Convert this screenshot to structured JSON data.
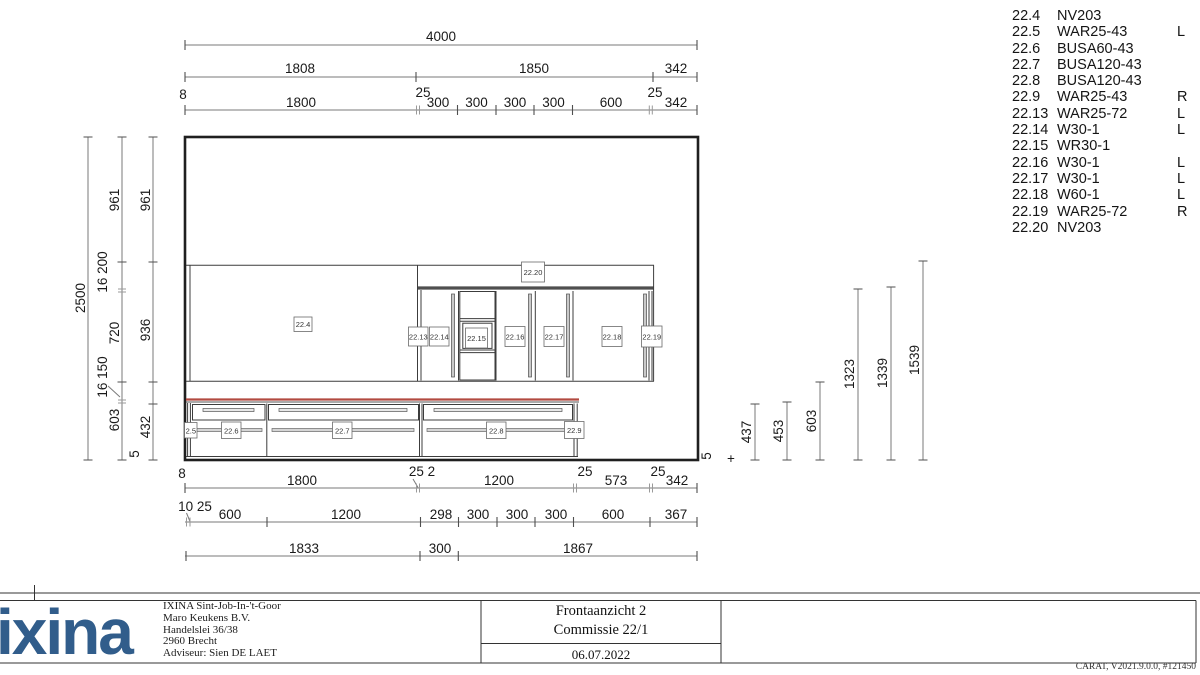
{
  "parts_list": {
    "rows": [
      {
        "code": "22.4",
        "name": "NV203",
        "side": ""
      },
      {
        "code": "22.5",
        "name": "WAR25-43",
        "side": "L"
      },
      {
        "code": "22.6",
        "name": "BUSA60-43",
        "side": ""
      },
      {
        "code": "22.7",
        "name": "BUSA120-43",
        "side": ""
      },
      {
        "code": "22.8",
        "name": "BUSA120-43",
        "side": ""
      },
      {
        "code": "22.9",
        "name": "WAR25-43",
        "side": "R"
      },
      {
        "code": "22.13",
        "name": "WAR25-72",
        "side": "L"
      },
      {
        "code": "22.14",
        "name": "W30-1",
        "side": "L"
      },
      {
        "code": "22.15",
        "name": "WR30-1",
        "side": ""
      },
      {
        "code": "22.16",
        "name": "W30-1",
        "side": "L"
      },
      {
        "code": "22.17",
        "name": "W30-1",
        "side": "L"
      },
      {
        "code": "22.18",
        "name": "W60-1",
        "side": "L"
      },
      {
        "code": "22.19",
        "name": "WAR25-72",
        "side": "R"
      },
      {
        "code": "22.20",
        "name": "NV203",
        "side": ""
      }
    ]
  },
  "dims": {
    "t1": [
      "4000"
    ],
    "t2": [
      "1808",
      "1850",
      "342"
    ],
    "t3s": [
      "8",
      "25",
      "25"
    ],
    "t3": [
      "1800",
      "300",
      "300",
      "300",
      "300",
      "600",
      "342"
    ],
    "b1": [
      "1800",
      "1200",
      "573",
      "342"
    ],
    "b1s": [
      "8",
      "25 2",
      "25",
      "25"
    ],
    "b2": [
      "600",
      "1200",
      "298",
      "300",
      "300",
      "300",
      "600",
      "367"
    ],
    "b2s": [
      "10 25"
    ],
    "b3": [
      "1833",
      "300",
      "1867"
    ],
    "l1": [
      "2500"
    ],
    "l2": [
      "961",
      "16 200",
      "720",
      "603",
      "5"
    ],
    "l3": [
      "961",
      "936",
      "16 150",
      "432"
    ],
    "r": [
      "437",
      "453",
      "603",
      "1323",
      "1339",
      "1539"
    ],
    "side5": "5",
    "plus": "+"
  },
  "unit_labels": {
    "p4": "22.4",
    "p20": "22.20",
    "p13": "22.13",
    "p14": "22.14",
    "p15": "22.15",
    "p16": "22.16",
    "p17": "22.17",
    "p18": "22.18",
    "p19": "22.19",
    "p5": "2.5",
    "p6": "22.6",
    "p7": "22.7",
    "p8": "22.8",
    "p9": "22.9"
  },
  "title_block": {
    "view": "Frontaanzicht 2",
    "commission": "Commissie 22/1",
    "date": "06.07.2022"
  },
  "company": {
    "logo_text": "ixina",
    "address_lines": [
      "IXINA Sint-Job-In-'t-Goor",
      "Maro Keukens B.V.",
      "Handelslei 36/38",
      "2960 Brecht",
      "Adviseur: Sien DE LAET"
    ]
  },
  "footer": {
    "software": "CARAT, V2021.9.0.0, #121450"
  },
  "colors": {
    "logo_blue": "#315d8b",
    "countertop_red": "#b24a41",
    "line_dark": "#1f1f1f",
    "dim_gray": "#7a7a7a"
  }
}
